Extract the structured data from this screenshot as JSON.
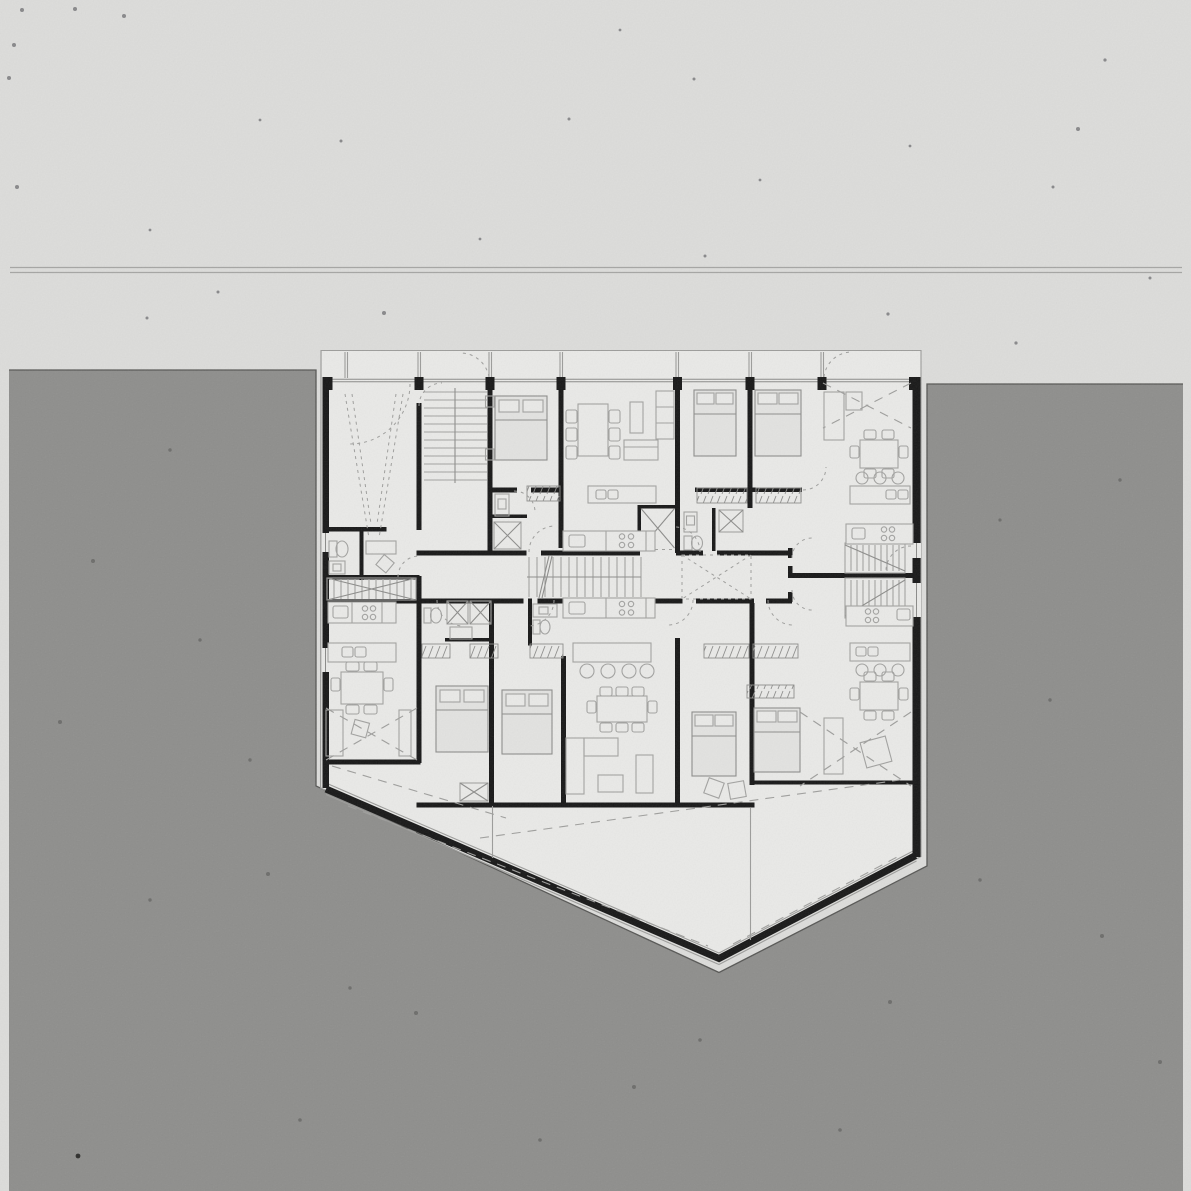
{
  "document": {
    "kind": "architectural floor plan",
    "media": "scanned paper drawing, monochrome",
    "view": "typical residential floor plan of a building with a pointed south prow, surrounded by dark site mass",
    "visible_text": "none"
  },
  "colors": {
    "paper": "#dcdcda",
    "planPaper": "#e9e9e7",
    "siteGray": "#8e8e8c",
    "siteEdge": "#575755",
    "wall": "#181818",
    "outline": "#9c9c9a",
    "furniture": "#a2a2a0",
    "furnitureDark": "#8d8d8b",
    "dash": "#9e9e9c",
    "glazing": "#8a8a88",
    "speck": "#88888a",
    "speckSite": "#6d6d6b",
    "boundary": "#a5a5a3",
    "bedFill": "#e2e2e0"
  },
  "site": {
    "boundary_line": "double survey/street line across sheet near top",
    "ground": "dark gray site poché wrapping west, east and south of the building"
  },
  "building": {
    "footprint": "irregular pentagon: flat north facade with balcony strip, vertical side walls, two splayed walls meeting at a south point",
    "cores": [
      "entry hall with ramp arrows",
      "main straight stair",
      "corridor stair",
      "elevator with X",
      "two duplex stairs on east side",
      "light void with dashed X"
    ],
    "rooms": [
      "bedrooms",
      "living-dining rooms",
      "kitchens",
      "bathrooms",
      "wardrobe corridors",
      "roof terrace with dashed slope lines"
    ],
    "furniture_symbols": [
      "double beds with pillows",
      "dining tables with chairs",
      "sofas and armchairs",
      "kitchen islands with stools",
      "counters with cooktop rings and sinks",
      "wardrobe rail hatching",
      "showers with X",
      "toilets and basins"
    ]
  }
}
